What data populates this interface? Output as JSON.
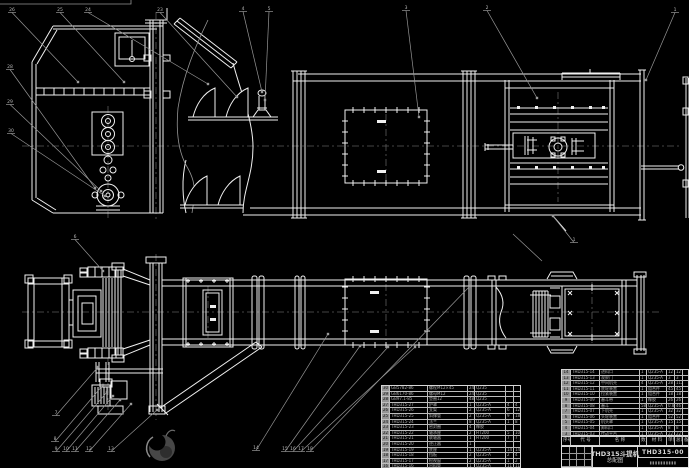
{
  "drawing": {
    "title_block": {
      "product": "THD315斗提机",
      "drawing_type": "总配图",
      "drawing_no": "THD315-00",
      "maker": "▮▮▮▮▮▮▮▮▮▮"
    },
    "bom_right": {
      "headers": [
        "序号",
        "代 号",
        "名 称",
        "数量",
        "材 料",
        "单件",
        "总计",
        "备注"
      ],
      "rows": [
        {
          "seq": "14",
          "code": "THD315-14",
          "name": "进料口",
          "qty": "1",
          "mat": "Q235-A",
          "w1": "12",
          "w2": "12",
          "note": ""
        },
        {
          "seq": "13",
          "code": "THD315-13",
          "name": "观察门",
          "qty": "1",
          "mat": "Q235-A",
          "w1": "3",
          "w2": "3",
          "note": ""
        },
        {
          "seq": "12",
          "code": "THD315-12",
          "name": "中间机壳",
          "qty": "4",
          "mat": "Q235-A",
          "w1": "28",
          "w2": "112",
          "note": ""
        },
        {
          "seq": "11",
          "code": "THD315-11",
          "name": "底轮装置",
          "qty": "1",
          "mat": "组合件",
          "w1": "45",
          "w2": "45",
          "note": ""
        },
        {
          "seq": "10",
          "code": "THD315-10",
          "name": "拉紧装置",
          "qty": "1",
          "mat": "组合件",
          "w1": "18",
          "w2": "18",
          "note": ""
        },
        {
          "seq": "9",
          "code": "THD315-09",
          "name": "畚斗带",
          "qty": "1",
          "mat": "橡胶",
          "w1": "26",
          "w2": "26",
          "note": ""
        },
        {
          "seq": "8",
          "code": "THD315-08",
          "name": "畚斗",
          "qty": "58",
          "mat": "Q235-A",
          "w1": "0.8",
          "w2": "46",
          "note": ""
        },
        {
          "seq": "7",
          "code": "THD315-07",
          "name": "下机壳",
          "qty": "1",
          "mat": "Q235-A",
          "w1": "32",
          "w2": "32",
          "note": ""
        },
        {
          "seq": "6",
          "code": "THD315-06",
          "name": "头轮装置",
          "qty": "1",
          "mat": "组合件",
          "w1": "52",
          "w2": "52",
          "note": ""
        },
        {
          "seq": "5",
          "code": "THD315-05",
          "name": "机头罩",
          "qty": "1",
          "mat": "Q235-A",
          "w1": "15",
          "w2": "15",
          "note": ""
        },
        {
          "seq": "4",
          "code": "THD315-04",
          "name": "卸料口",
          "qty": "1",
          "mat": "Q235-A",
          "w1": "8",
          "w2": "8",
          "note": ""
        },
        {
          "seq": "3",
          "code": "THD315-03",
          "name": "传动平台",
          "qty": "1",
          "mat": "Q235-A",
          "w1": "22",
          "w2": "22",
          "note": ""
        },
        {
          "seq": "2",
          "code": "THD315-02",
          "name": "减速器",
          "qty": "1",
          "mat": "",
          "w1": "",
          "w2": "",
          "note": "外购"
        },
        {
          "seq": "1",
          "code": "THD315-01",
          "name": "电动机",
          "qty": "1",
          "mat": "",
          "w1": "",
          "w2": "",
          "note": "外购"
        }
      ]
    },
    "bom_left": {
      "rows": [
        {
          "seq": "30",
          "code": "GB5782-86",
          "name": "螺栓M12×45",
          "qty": "24",
          "mat": "Q235",
          "w1": "",
          "w2": ""
        },
        {
          "seq": "29",
          "code": "GB6170-86",
          "name": "螺母M12",
          "qty": "24",
          "mat": "Q235",
          "w1": "",
          "w2": ""
        },
        {
          "seq": "28",
          "code": "GB97.1-85",
          "name": "垫圈12",
          "qty": "48",
          "mat": "Q235",
          "w1": "",
          "w2": ""
        },
        {
          "seq": "27",
          "code": "THD315-27",
          "name": "护罩",
          "qty": "1",
          "mat": "Q235-A",
          "w1": "4",
          "w2": "4"
        },
        {
          "seq": "26",
          "code": "THD315-26",
          "name": "支架",
          "qty": "2",
          "mat": "Q235-A",
          "w1": "6",
          "w2": "12"
        },
        {
          "seq": "25",
          "code": "THD315-25",
          "name": "斜撑管",
          "qty": "2",
          "mat": "Q235-A",
          "w1": "9",
          "w2": "18"
        },
        {
          "seq": "24",
          "code": "THD315-24",
          "name": "法兰",
          "qty": "8",
          "mat": "Q235-A",
          "w1": "1",
          "w2": "8"
        },
        {
          "seq": "23",
          "code": "THD315-23",
          "name": "密封圈",
          "qty": "4",
          "mat": "橡胶",
          "w1": "",
          "w2": ""
        },
        {
          "seq": "22",
          "code": "THD315-22",
          "name": "轴承座",
          "qty": "2",
          "mat": "HT200",
          "w1": "5",
          "w2": "10"
        },
        {
          "seq": "21",
          "code": "THD315-21",
          "name": "联轴器",
          "qty": "1",
          "mat": "HT200",
          "w1": "7",
          "w2": "7"
        },
        {
          "seq": "20",
          "code": "THD315-20",
          "name": "逆止器",
          "qty": "1",
          "mat": "",
          "w1": "",
          "w2": ""
        },
        {
          "seq": "19",
          "code": "THD315-19",
          "name": "底座",
          "qty": "1",
          "mat": "Q235-A",
          "w1": "14",
          "w2": "14"
        },
        {
          "seq": "18",
          "code": "THD315-18",
          "name": "挡板",
          "qty": "2",
          "mat": "Q235-A",
          "w1": "2",
          "w2": "4"
        },
        {
          "seq": "17",
          "code": "THD315-17",
          "name": "检视窗",
          "qty": "2",
          "mat": "Q235-A",
          "w1": "1",
          "w2": "2"
        },
        {
          "seq": "16",
          "code": "THD315-16",
          "name": "出料管",
          "qty": "1",
          "mat": "Q235-A",
          "w1": "11",
          "w2": "11"
        },
        {
          "seq": "15",
          "code": "THD315-15",
          "name": "弯头机壳",
          "qty": "1",
          "mat": "Q235-A",
          "w1": "19",
          "w2": "19"
        }
      ]
    },
    "balloons": [
      {
        "label": "26",
        "x": 12,
        "y": 7,
        "tx": 78,
        "ty": 82
      },
      {
        "label": "25",
        "x": 60,
        "y": 7,
        "tx": 124,
        "ty": 82
      },
      {
        "label": "24",
        "x": 88,
        "y": 7,
        "tx": 208,
        "ty": 84
      },
      {
        "label": "23",
        "x": 160,
        "y": 7,
        "tx": 237,
        "ty": 97
      },
      {
        "label": "4",
        "x": 243,
        "y": 6,
        "tx": 262,
        "ty": 92
      },
      {
        "label": "5",
        "x": 269,
        "y": 6,
        "tx": 265,
        "ty": 100
      },
      {
        "label": "3",
        "x": 406,
        "y": 5,
        "tx": 419,
        "ty": 117
      },
      {
        "label": "2",
        "x": 487,
        "y": 5,
        "tx": 537,
        "ty": 98
      },
      {
        "label": "1",
        "x": 675,
        "y": 7,
        "tx": 646,
        "ty": 80
      },
      {
        "label": "28",
        "x": 10,
        "y": 64,
        "tx": 95,
        "ty": 188
      },
      {
        "label": "29",
        "x": 10,
        "y": 99,
        "tx": 101,
        "ty": 191
      },
      {
        "label": "30",
        "x": 11,
        "y": 128,
        "tx": 105,
        "ty": 196
      },
      {
        "label": "6",
        "x": 75,
        "y": 234,
        "tx": 103,
        "ty": 271
      },
      {
        "label": "1",
        "x": 574,
        "y": 237,
        "tx": 553,
        "ty": 216
      },
      {
        "label": "7",
        "x": 56,
        "y": 410,
        "tx": 98,
        "ty": 367
      },
      {
        "label": "8",
        "x": 55,
        "y": 436,
        "tx": 103,
        "ty": 385
      },
      {
        "label": "9",
        "x": 56,
        "y": 446,
        "tx": 107,
        "ty": 392
      },
      {
        "label": "10",
        "x": 66,
        "y": 446,
        "tx": 113,
        "ty": 396
      },
      {
        "label": "11",
        "x": 75,
        "y": 446,
        "tx": 120,
        "ty": 400
      },
      {
        "label": "12",
        "x": 89,
        "y": 446,
        "tx": 131,
        "ty": 404
      },
      {
        "label": "13",
        "x": 111,
        "y": 446,
        "tx": 157,
        "ty": 410
      },
      {
        "label": "14",
        "x": 256,
        "y": 445,
        "tx": 328,
        "ty": 334
      },
      {
        "label": "15",
        "x": 285,
        "y": 446,
        "tx": 360,
        "ty": 346
      },
      {
        "label": "16",
        "x": 293,
        "y": 446,
        "tx": 388,
        "ty": 347
      },
      {
        "label": "17",
        "x": 301,
        "y": 446,
        "tx": 415,
        "ty": 347
      },
      {
        "label": "18",
        "x": 310,
        "y": 446,
        "tx": 470,
        "ty": 286
      }
    ],
    "extra_leaders": [
      {
        "x1": 513,
        "y1": 234,
        "x2": 542,
        "y2": 261
      }
    ],
    "colors": {
      "background": "#000000",
      "line": "#f0f0f0",
      "secondary": "#969696",
      "table_text": "#aeaeae"
    }
  }
}
